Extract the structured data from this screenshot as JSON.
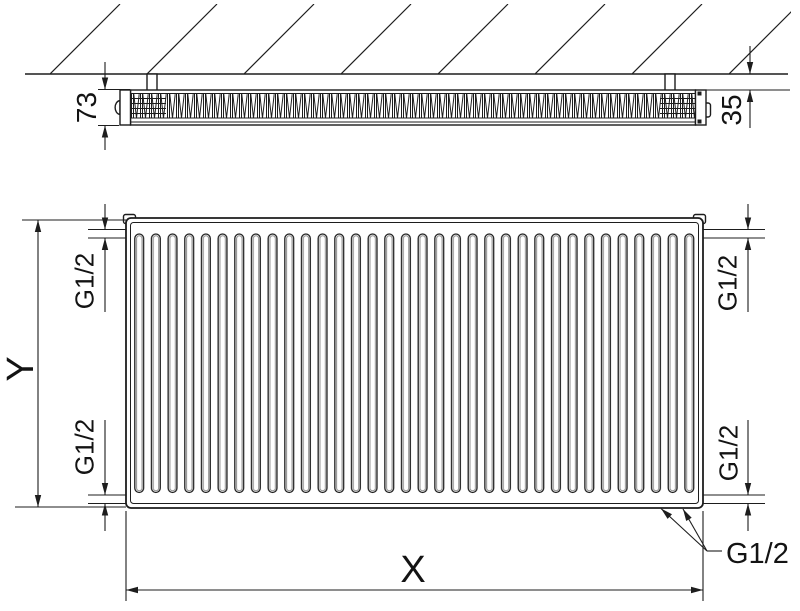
{
  "meta": {
    "description": "Technical dimension drawing of a panel radiator: top cross-section view mounted at a hatched wall, and front view with groove pattern",
    "colors": {
      "line": "#1d1d1d",
      "background": "#ffffff",
      "groove_shade": "#909090"
    }
  },
  "top_view": {
    "depth_label": "73",
    "wall_gap_label": "35"
  },
  "front_view": {
    "height_label": "Y",
    "width_label": "X",
    "conn_top_left": "G1/2",
    "conn_bottom_left": "G1/2",
    "conn_top_right": "G1/2",
    "conn_bottom_right": "G1/2",
    "conn_bottom_leader": "G1/2"
  }
}
